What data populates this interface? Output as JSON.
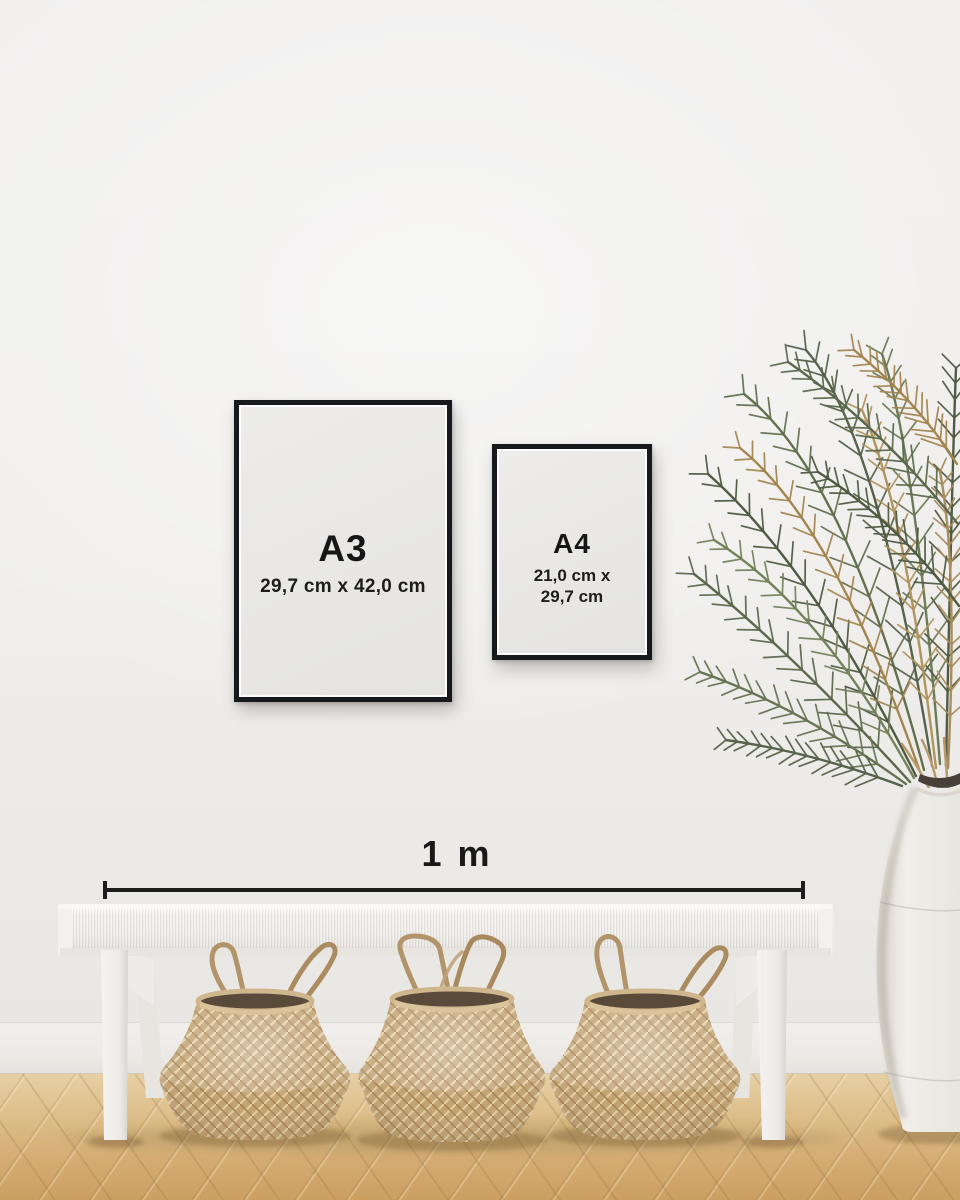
{
  "frames": [
    {
      "label": "A3",
      "size_lines": [
        "29,7 cm x 42,0 cm"
      ]
    },
    {
      "label": "A4",
      "size_lines": [
        "21,0 cm x",
        "29,7 cm"
      ]
    }
  ],
  "scale": {
    "label": "1 m"
  },
  "palette": {
    "wall": "#efeeec",
    "frame_black": "#17191c",
    "paper": "#e9e8e6",
    "text": "#161616",
    "scale_line": "#1d1d1d",
    "bench_white": "#f4f3f1",
    "basket_tan": "#c4a577",
    "plant_green": "#5b684c",
    "plant_dried": "#a3854f",
    "floor_wood": "#d8b076",
    "vase_white": "#efece8"
  }
}
